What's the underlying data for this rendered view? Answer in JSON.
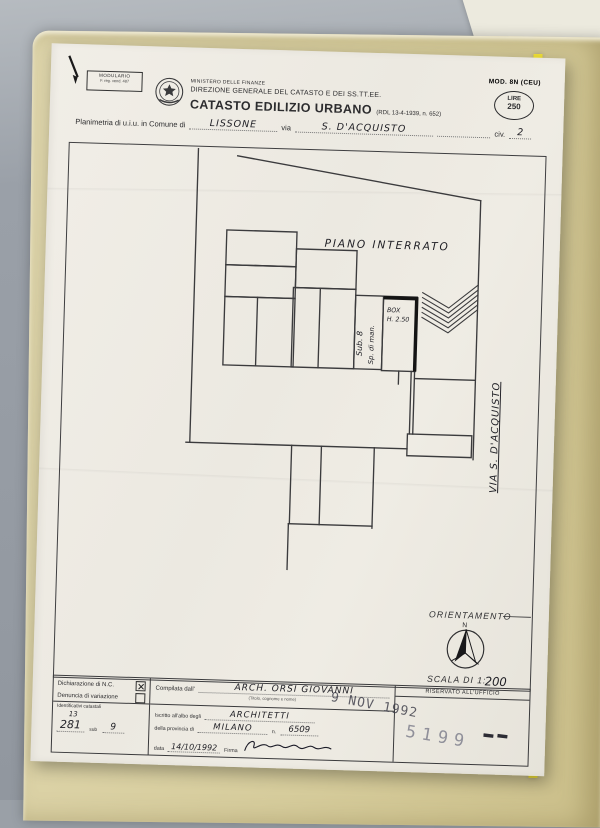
{
  "colors": {
    "background": "#9aa0a7",
    "folder": "#d6cc9c",
    "folder_strip": "#f2e135",
    "paper": "#edeae2",
    "ink": "#2c2c2e",
    "stamp_gray": "#90909a",
    "stamp_dark": "#3e3e4a"
  },
  "modulario": {
    "line1": "MODULARIO",
    "line2": "F. reg. vend. 487"
  },
  "header": {
    "ministry": "MINISTERO DELLE FINANZE",
    "direction": "DIREZIONE GENERALE DEL CATASTO E DEI SS.TT.EE.",
    "title": "CATASTO EDILIZIO URBANO",
    "title_ref": "(RDL 13-4-1939, n. 652)",
    "mod": "MOD. 8N (CEU)",
    "lire_label": "LIRE",
    "lire_value": "250"
  },
  "subject": {
    "label_planimetria": "Planimetria di u.i.u. in Comune di",
    "comune": "LISSONE",
    "label_via": "via",
    "via": "S. D'ACQUISTO",
    "label_civ": "civ.",
    "civ": "2"
  },
  "plan": {
    "floor_label": "PIANO INTERRATO",
    "box_line1": "BOX",
    "box_line2": "H. 2.50",
    "adjacent_line1": "Sp. di man.",
    "adjacent_line2": "Sub. 8",
    "street_label": "VIA  S. D'ACQUISTO",
    "orientation_label": "ORIENTAMENTO",
    "north_label": "N",
    "scale_label": "SCALA DI 1:",
    "scale_value": "200"
  },
  "footer": {
    "declaration_nc": "Dichiarazione di N.C.",
    "declaration_var": "Denuncia di variazione",
    "compiled_label": "Compilata dall'",
    "compiled_value": "ARCH. ORSI GIOVANNI",
    "compiled_sub": "(Titolo, cognome e nome)",
    "reserved_label": "RISERVATO ALL'UFFICIO",
    "albo_label": "Iscritto all'albo degli",
    "albo_value": "ARCHITETTI",
    "prov_label": "della provincia di",
    "prov_value": "MILANO",
    "num_label": "n.",
    "num_value": "6509",
    "date_label": "data",
    "date_value": "14/10/1992",
    "firma_label": "Firma",
    "id_label": "Identificativi catastali",
    "id_over": "13",
    "id_value": "281",
    "id_sub_label": "sub",
    "id_sub_value": "9",
    "date_stamp": "9 NOV 1992",
    "protocol_stamp": "5199"
  }
}
